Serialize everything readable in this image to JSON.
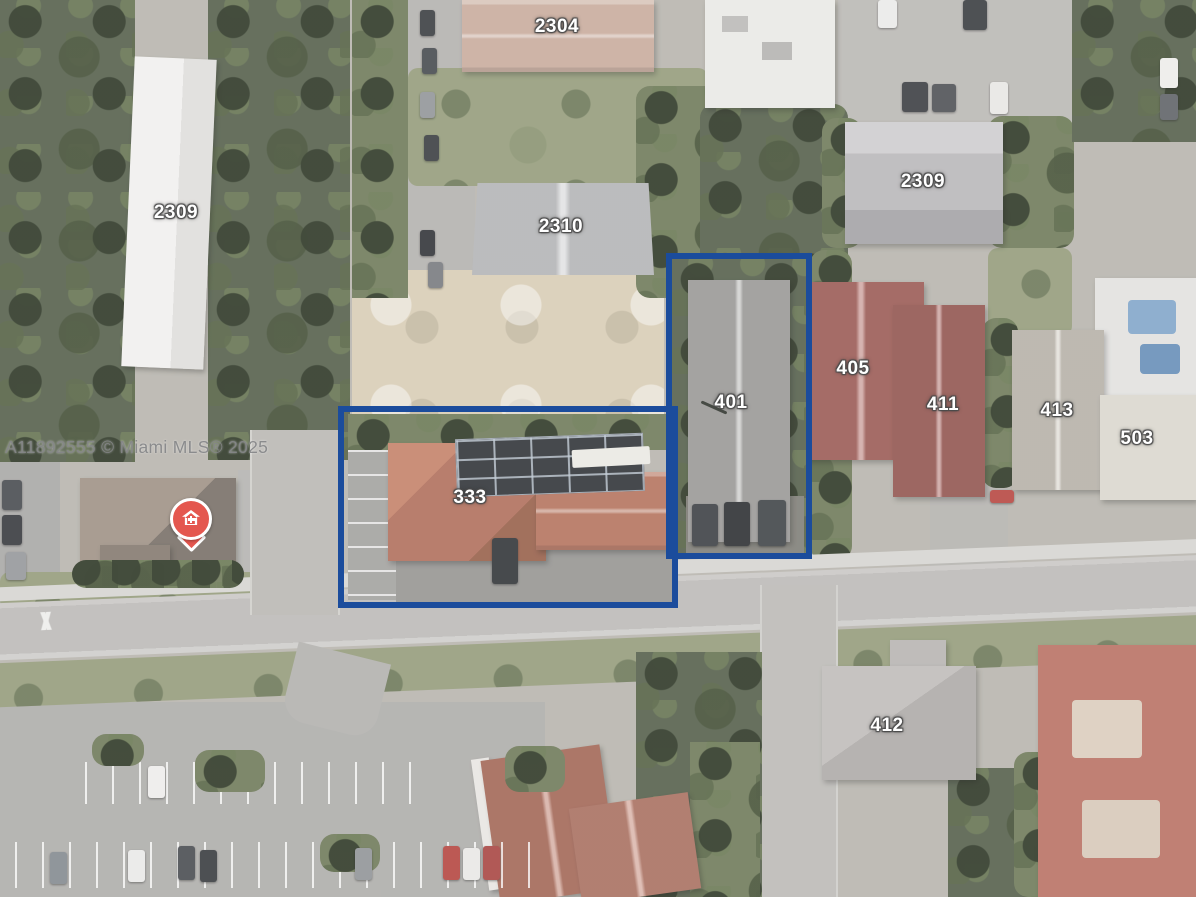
{
  "image_type": "aerial-satellite-listing-photo",
  "watermark": "A11892555 © Miami MLS® 2025",
  "map": {
    "labels": [
      {
        "id": "2304",
        "text": "2304"
      },
      {
        "id": "2309-left",
        "text": "2309"
      },
      {
        "id": "2310",
        "text": "2310"
      },
      {
        "id": "2309-right",
        "text": "2309"
      },
      {
        "id": "401",
        "text": "401"
      },
      {
        "id": "405",
        "text": "405"
      },
      {
        "id": "411",
        "text": "411"
      },
      {
        "id": "413",
        "text": "413"
      },
      {
        "id": "503",
        "text": "503"
      },
      {
        "id": "333",
        "text": "333"
      },
      {
        "id": "412",
        "text": "412"
      }
    ],
    "highlight_boxes": [
      {
        "around": "333",
        "color": "#1b4c9c"
      },
      {
        "around": "401",
        "color": "#1b4c9c"
      }
    ],
    "marker": {
      "name": "medical-home-pin",
      "color": "#e4574f"
    },
    "label_style": {
      "text_color": "#ffffff",
      "outline_color": "#4a4a4a"
    }
  }
}
